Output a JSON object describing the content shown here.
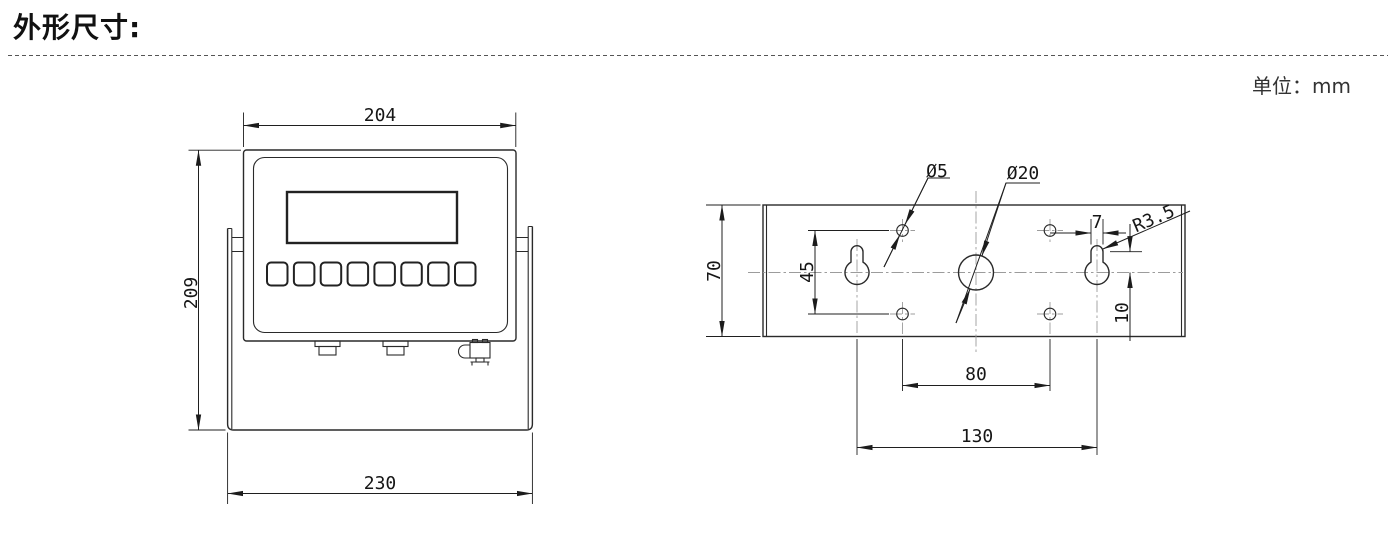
{
  "page": {
    "title": "外形尺寸:",
    "unit_label": "单位：mm"
  },
  "front_view": {
    "top_width": "204",
    "height": "209",
    "bottom_width": "230"
  },
  "back_view": {
    "plate_height": "70",
    "vertical_hole_span": "45",
    "small_hole_dia": "Ø5",
    "center_hole_dia": "Ø20",
    "keyhole_slot_width": "7",
    "keyhole_slot_radius": "R3.5",
    "slot_center_offset": "10",
    "bottom_hole_span": "80",
    "keyhole_span": "130"
  }
}
